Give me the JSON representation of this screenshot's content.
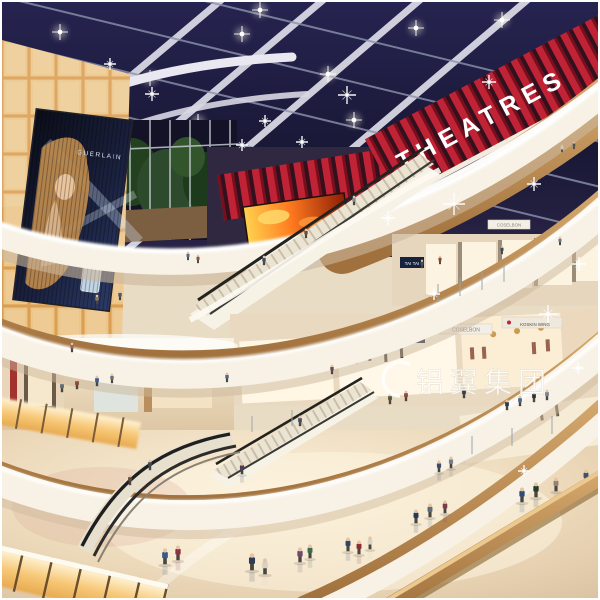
{
  "scene": {
    "type": "shopping-mall-atrium-interior-rendering",
    "watermark_text": "铝翼集团",
    "theatres_sign": "THEATRES",
    "billboard": {
      "brand": "GUERLAIN"
    },
    "stores": {
      "tai_tai_upper": "TAI TAI",
      "tai_tai_lower": "TAI TAI",
      "coselbon": "COSELBON",
      "koskin_wing": "KOSKIN WING"
    },
    "colors": {
      "skylight_navy": "#1e1d3f",
      "beam_white": "#d8d8e4",
      "theatre_red": "#c02336",
      "amber_panel": "#f6cf8e",
      "cream_fascia": "#f8f2e6",
      "wood_rail": "#c1955e",
      "floor_beige": "#e9d8bc",
      "fire_screen_orange": "#ff7a1f",
      "tree_green": "#2e4a2c"
    }
  }
}
